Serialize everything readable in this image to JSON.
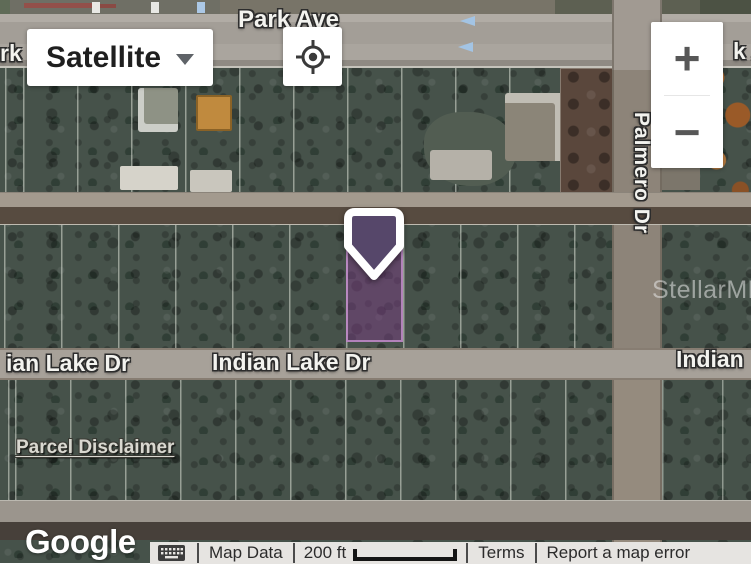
{
  "map_controls": {
    "map_type_label": "Satellite",
    "zoom_in": "+",
    "zoom_out": "−"
  },
  "streets": {
    "park_ave": "Park Ave",
    "park_ave_left_partial": "rk",
    "park_ave_right_partial": "k A",
    "palmero_dr": "Palmero Dr",
    "indian_lake_dr_left_partial": "ian Lake Dr",
    "indian_lake_dr": "Indian Lake Dr",
    "indian_lake_dr_right_partial": "Indian"
  },
  "overlay": {
    "watermark": "StellarMLS",
    "parcel_disclaimer_link": "Parcel Disclaimer"
  },
  "attribution": {
    "logo": "Google",
    "map_data_label": "Map Data",
    "scale_label": "200 ft",
    "terms_label": "Terms",
    "report_label": "Report a map error"
  },
  "marker": {
    "pin_fill": "#56476a",
    "parcel_fill": "#7a3c82",
    "parcel_border": "#c791d0"
  }
}
